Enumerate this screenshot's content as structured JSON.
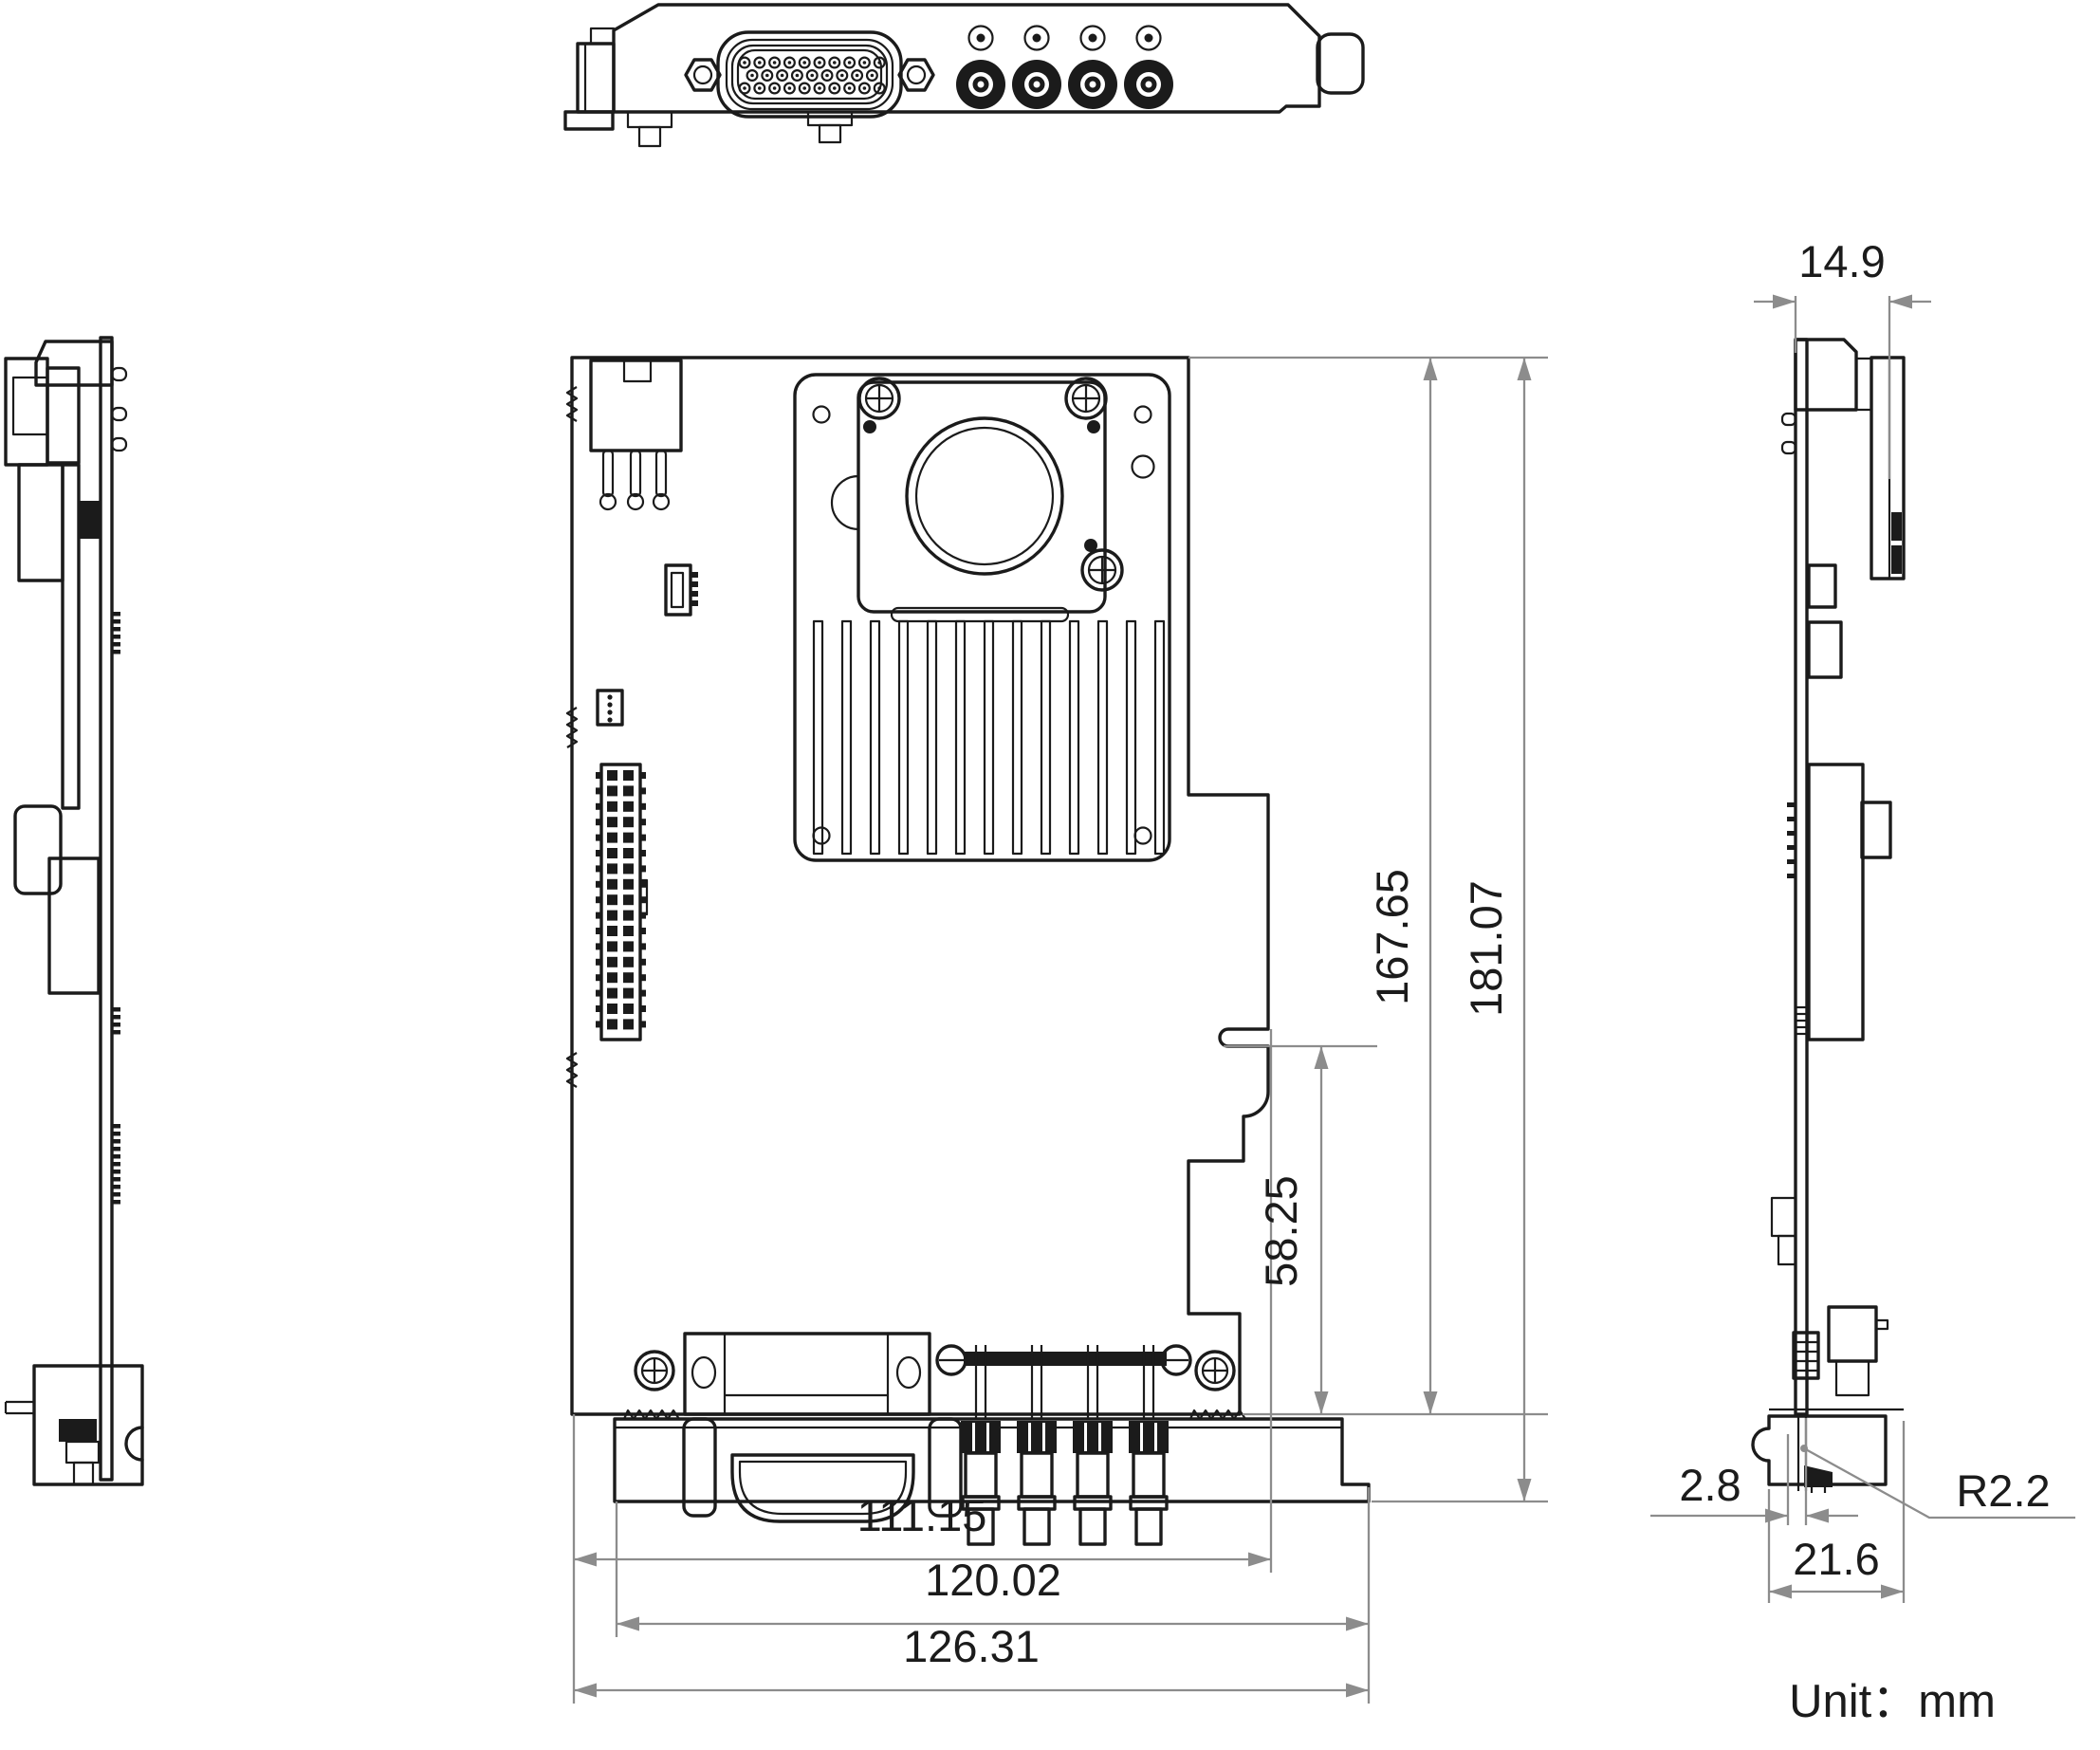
{
  "drawing": {
    "title": "PCIe capture card mechanical drawing",
    "unit_label": "Unit：mm",
    "dimensions": {
      "side_top_width": "14.9",
      "board_height": "167.65",
      "overall_height": "181.07",
      "notch_height": "58.25",
      "board_width": "111.15",
      "bracket_width": "120.02",
      "overall_width": "126.31",
      "foot_offset": "2.8",
      "corner_radius": "R2.2",
      "foot_width": "21.6"
    },
    "colors": {
      "line": "#1b1b1b",
      "dimension": "#8c8c8c",
      "background": "#ffffff"
    }
  }
}
